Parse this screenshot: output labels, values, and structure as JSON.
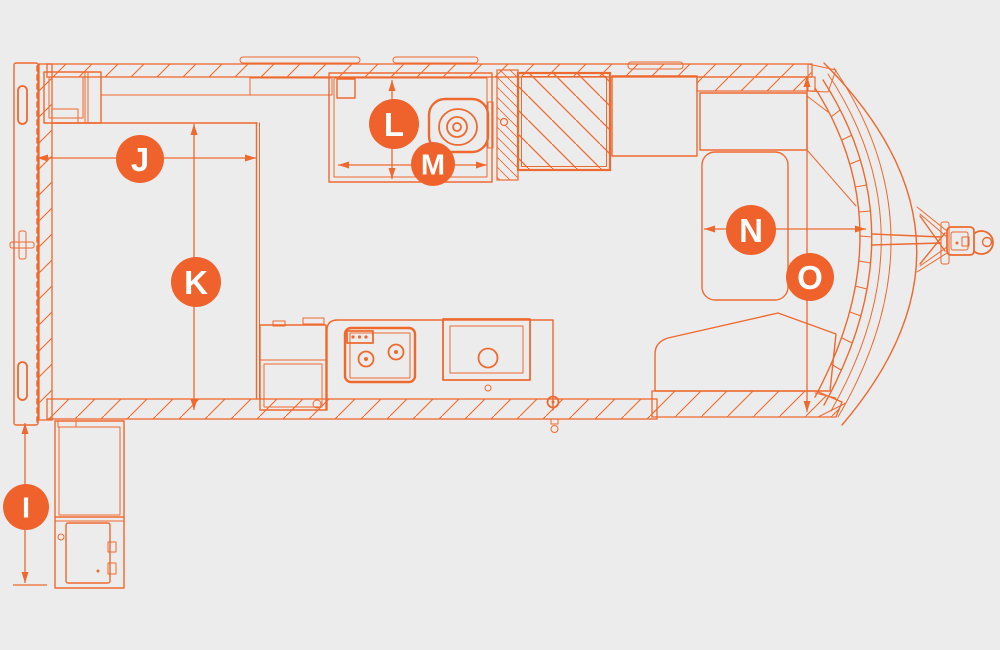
{
  "diagram": {
    "type": "caravan-floorplan",
    "colors": {
      "accent": "#F0622B",
      "line": "#EE692E",
      "background": "#ECECEC",
      "marker_text": "#FFFFFF"
    },
    "markers": {
      "I": "I",
      "J": "J",
      "K": "K",
      "L": "L",
      "M": "M",
      "N": "N",
      "O": "O"
    },
    "icon_names": [
      "dimension-marker-badge",
      "dimension-arrow",
      "toilet-icon",
      "stove-icon",
      "sink-icon",
      "hitch-coupling-icon"
    ]
  }
}
